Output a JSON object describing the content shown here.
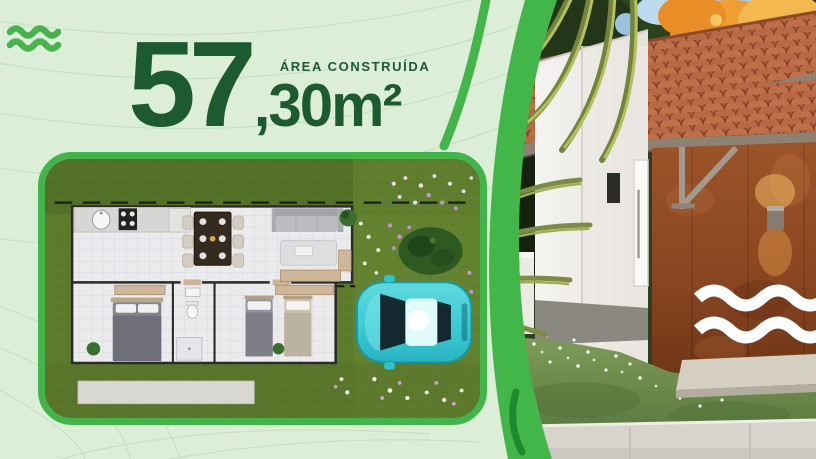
{
  "headline": {
    "number": "57",
    "decimal_unit": ",30m²",
    "label": "ÁREA CONSTRUÍDA"
  },
  "icons": {
    "top_left": "double-wave-icon",
    "rust_wall_logo": "double-wave-icon"
  },
  "colors": {
    "background_light_green": "#dcedd8",
    "brand_green": "#41b549",
    "headline_dark_green": "#1c5b30",
    "plan_grass": "#5d7b2c",
    "car_cyan": "#3fcdd6",
    "roof_terracotta": "#b2603c",
    "rust_wall": "#8f4c26",
    "wave_logo_white": "#ffffff"
  },
  "scene": {
    "left": "top-down floor plan with lawn, parked car and flower beds",
    "right": "exterior render of house with terracotta roof, white walls and rust feature wall"
  }
}
